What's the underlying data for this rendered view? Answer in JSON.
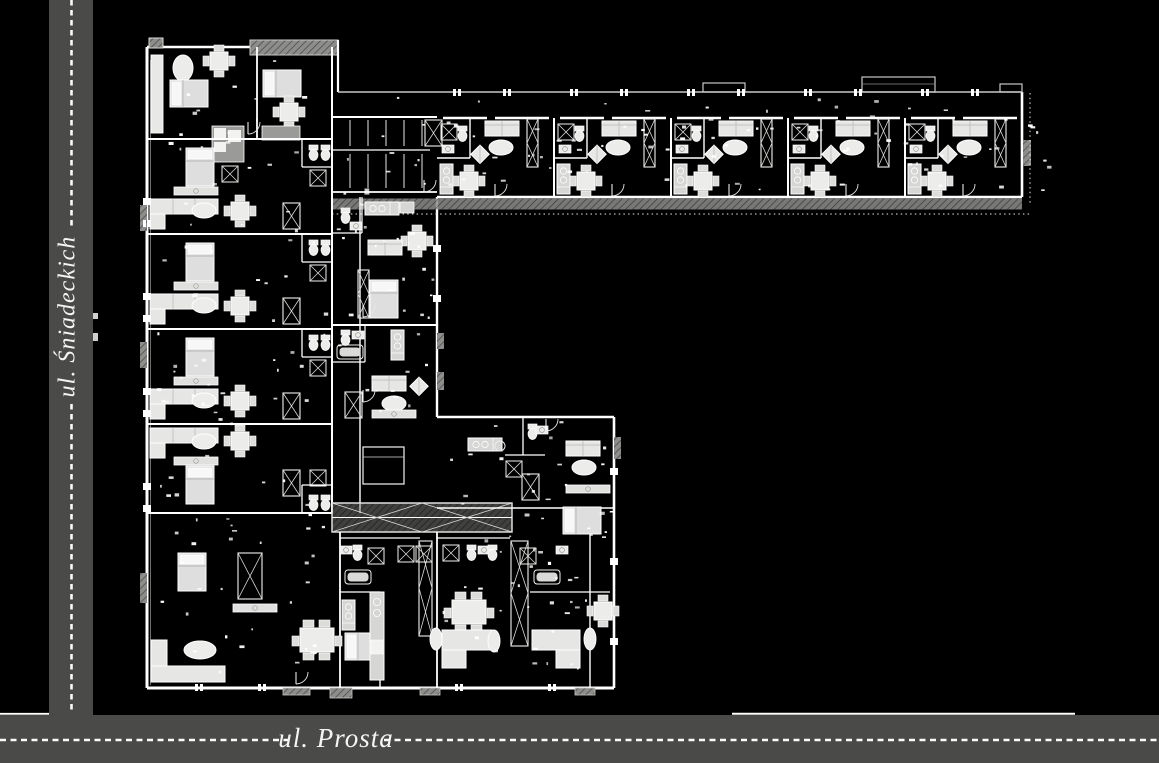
{
  "streets": {
    "vertical": {
      "label": "ul. Śniadeckich",
      "orientation": "vertical-left"
    },
    "horizontal": {
      "label": "ul. Prosta",
      "orientation": "horizontal-bottom"
    }
  },
  "colors": {
    "background": "#000000",
    "road": "#4a4a48",
    "road_marking": "#fafafa",
    "wall": "#ffffff",
    "furniture": "#e4e4e2",
    "balcony_hatch": "#8d8d8b",
    "thin_line": "#c8c8c6"
  }
}
